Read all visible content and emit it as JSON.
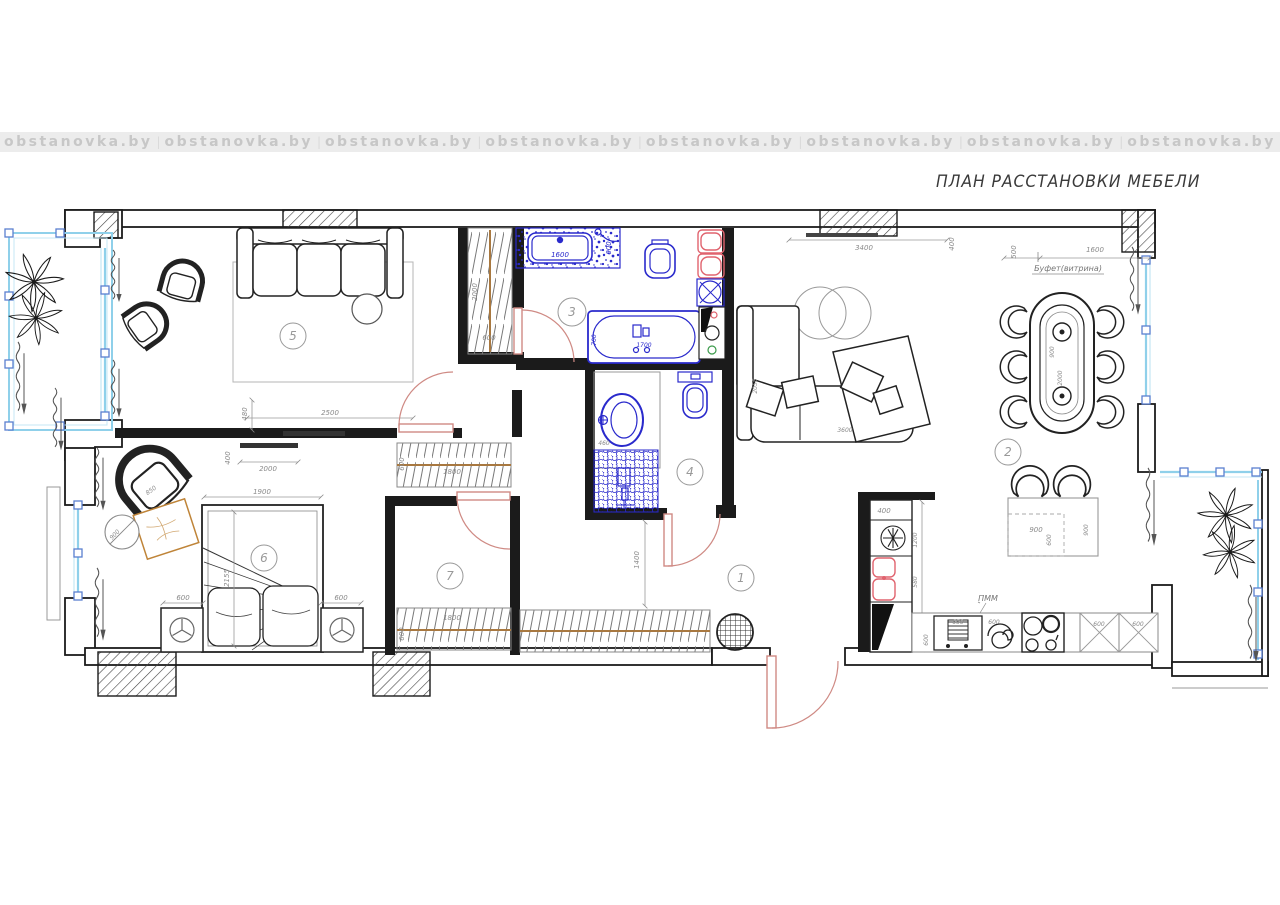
{
  "watermark": {
    "text": "obstanovka.by",
    "separator": "|"
  },
  "title": "ПЛАН РАССТАНОВКИ МЕБЕЛИ",
  "rooms": {
    "hall": "1",
    "kitchen_living": "2",
    "bathroom": "3",
    "wc": "4",
    "living": "5",
    "bedroom": "6",
    "closet": "7"
  },
  "labels": {
    "buffet": "Буфет(витрина)",
    "dishwasher": "ПММ"
  },
  "dims": {
    "living": {
      "tv_width": "2500",
      "tv_offset": "480"
    },
    "bedroom": {
      "tv_width": "2000",
      "tv_offset": "400",
      "bed_width": "1900",
      "bed_length": "2155",
      "nightstand_left": "600",
      "nightstand_right": "600",
      "armchair": "850",
      "table": "900"
    },
    "closet": {
      "rail_top_len": "1800",
      "rail_top_depth": "600",
      "rail_bot_len": "1800",
      "rail_bot_depth": "600"
    },
    "hall": {
      "width": "1400"
    },
    "wardrobe": {
      "length": "2000",
      "depth": "600"
    },
    "bathroom": {
      "counter_len": "1600",
      "counter_depth": "600",
      "bath_len": "1700",
      "bath_width": "700"
    },
    "wc": {
      "sink": "460"
    },
    "great_room": {
      "window": "3400",
      "offset": "400",
      "buffet_depth": "500",
      "buffet_len": "1600",
      "sofa_len": "3600",
      "sofa_depth": "2055",
      "table_width": "900",
      "table_len": "2000"
    },
    "island": {
      "width": "900",
      "depth": "600",
      "length": "900"
    },
    "kitchen": {
      "upper": "400",
      "fridge": "1200",
      "sink": "580",
      "corner": "600",
      "base": "600",
      "oven": "650",
      "hood": "600",
      "cab1": "600",
      "cab2": "600"
    }
  },
  "colors": {
    "plumbing_blue": "#2a2acc",
    "fixture_red": "#e0636e",
    "door_red": "#cf8a84",
    "window_blue": "#8fd0ea",
    "rug_orange": "#bf8438",
    "rail_brown": "#a87840",
    "wall_black": "#1b1b1b",
    "watermark_gray": "#c7c7c7"
  }
}
